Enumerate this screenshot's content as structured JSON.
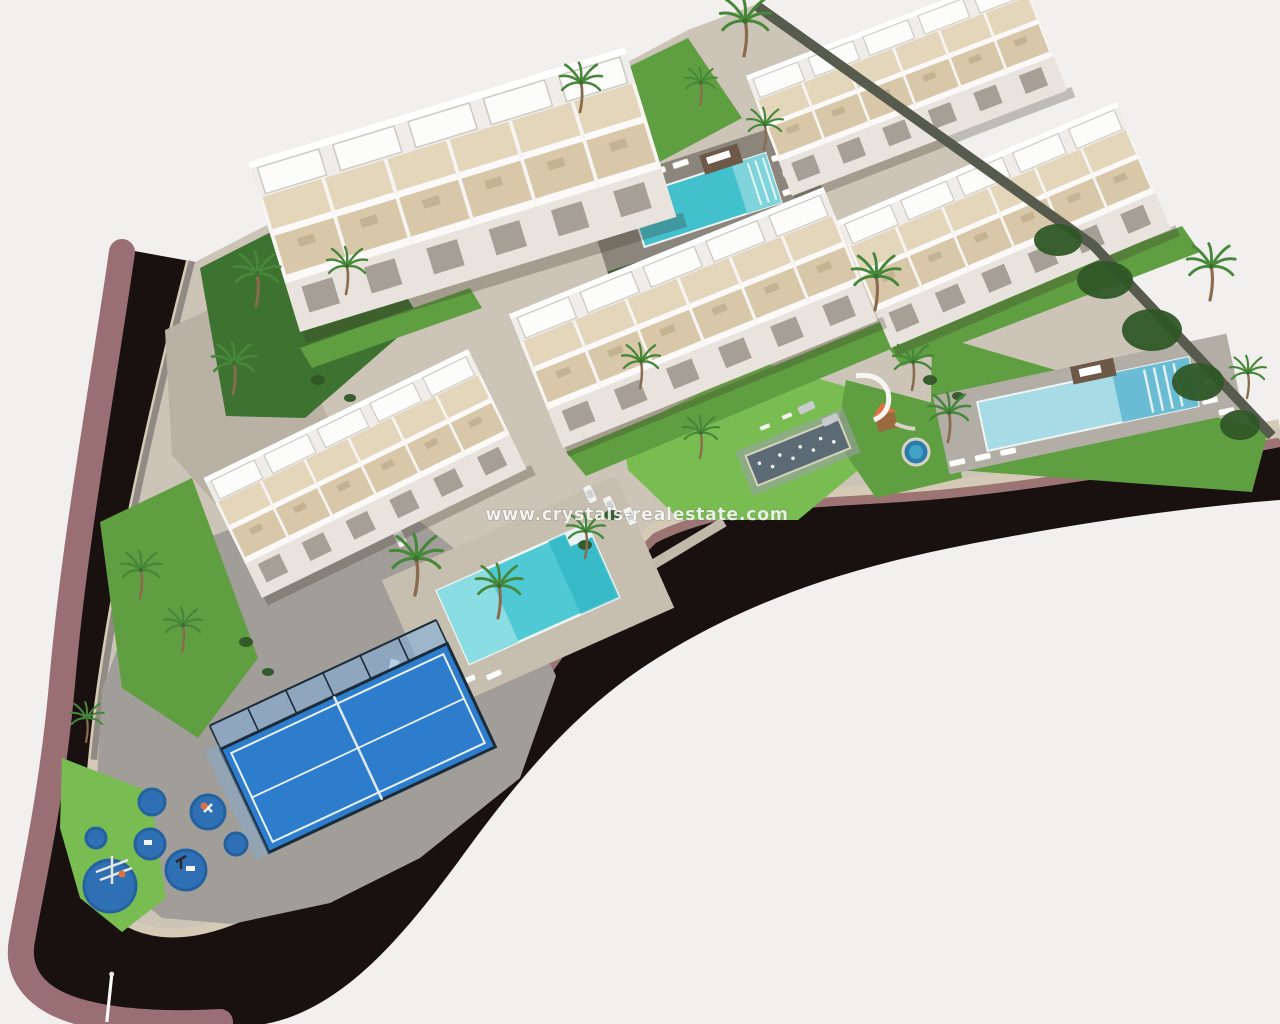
{
  "scene": {
    "type": "aerial-3d-architectural-render",
    "subject": "residential apartment complex masterplan",
    "watermark": {
      "text": "www.crystals-realestate.com"
    },
    "counts": {
      "apartment_buildings": 5,
      "swimming_pools": 3,
      "padel_courts": 1,
      "play_areas": 2,
      "palm_trees": 20,
      "parked_cars": 8
    },
    "features": [
      "terraced white apartment blocks with rooftop pergolas",
      "communal pools with sun loungers and timber decks",
      "glass-walled padel court",
      "children's playground on blue safety circles",
      "landscaped gardens with palm trees",
      "perimeter road with mauve sidewalk and stone retaining walls",
      "water-feature plaza and parking bays"
    ]
  },
  "colors": {
    "background": "#f2f0ee",
    "road_asphalt": "#18110f",
    "sidewalk": "#9a6f74",
    "wall_face": "#9b7473",
    "wall_cap": "#d5cab6",
    "wall_gray": "#8f8b84",
    "paving": "#ccc5b7",
    "plaza": "#a19e99",
    "slope_stone": "#b8b1a4",
    "lawn": "#5f9e41",
    "lawn_bright": "#79bd52",
    "lawn_dark": "#3e7230",
    "hedge": "#2f5727",
    "deck_top": "#8b857b",
    "deck_right": "#b2aea6",
    "deck_center": "#c6bfb0",
    "pool_top": "#42c0cc",
    "pool_center": "#4fc9d3",
    "pool_center_light": "#8adde2",
    "pool_right": "#a7dce6",
    "pool_right_deep": "#63b8d0",
    "padel_court": "#2e7ccc",
    "padel_glass": "#7fb0de",
    "playground_blue": "#2f6fb4",
    "playground_ring": "#24619f",
    "fountain": "#5c6b73",
    "wood": "#6e5847",
    "accent_orange": "#df7040",
    "wall_trees": "#565b4e"
  }
}
